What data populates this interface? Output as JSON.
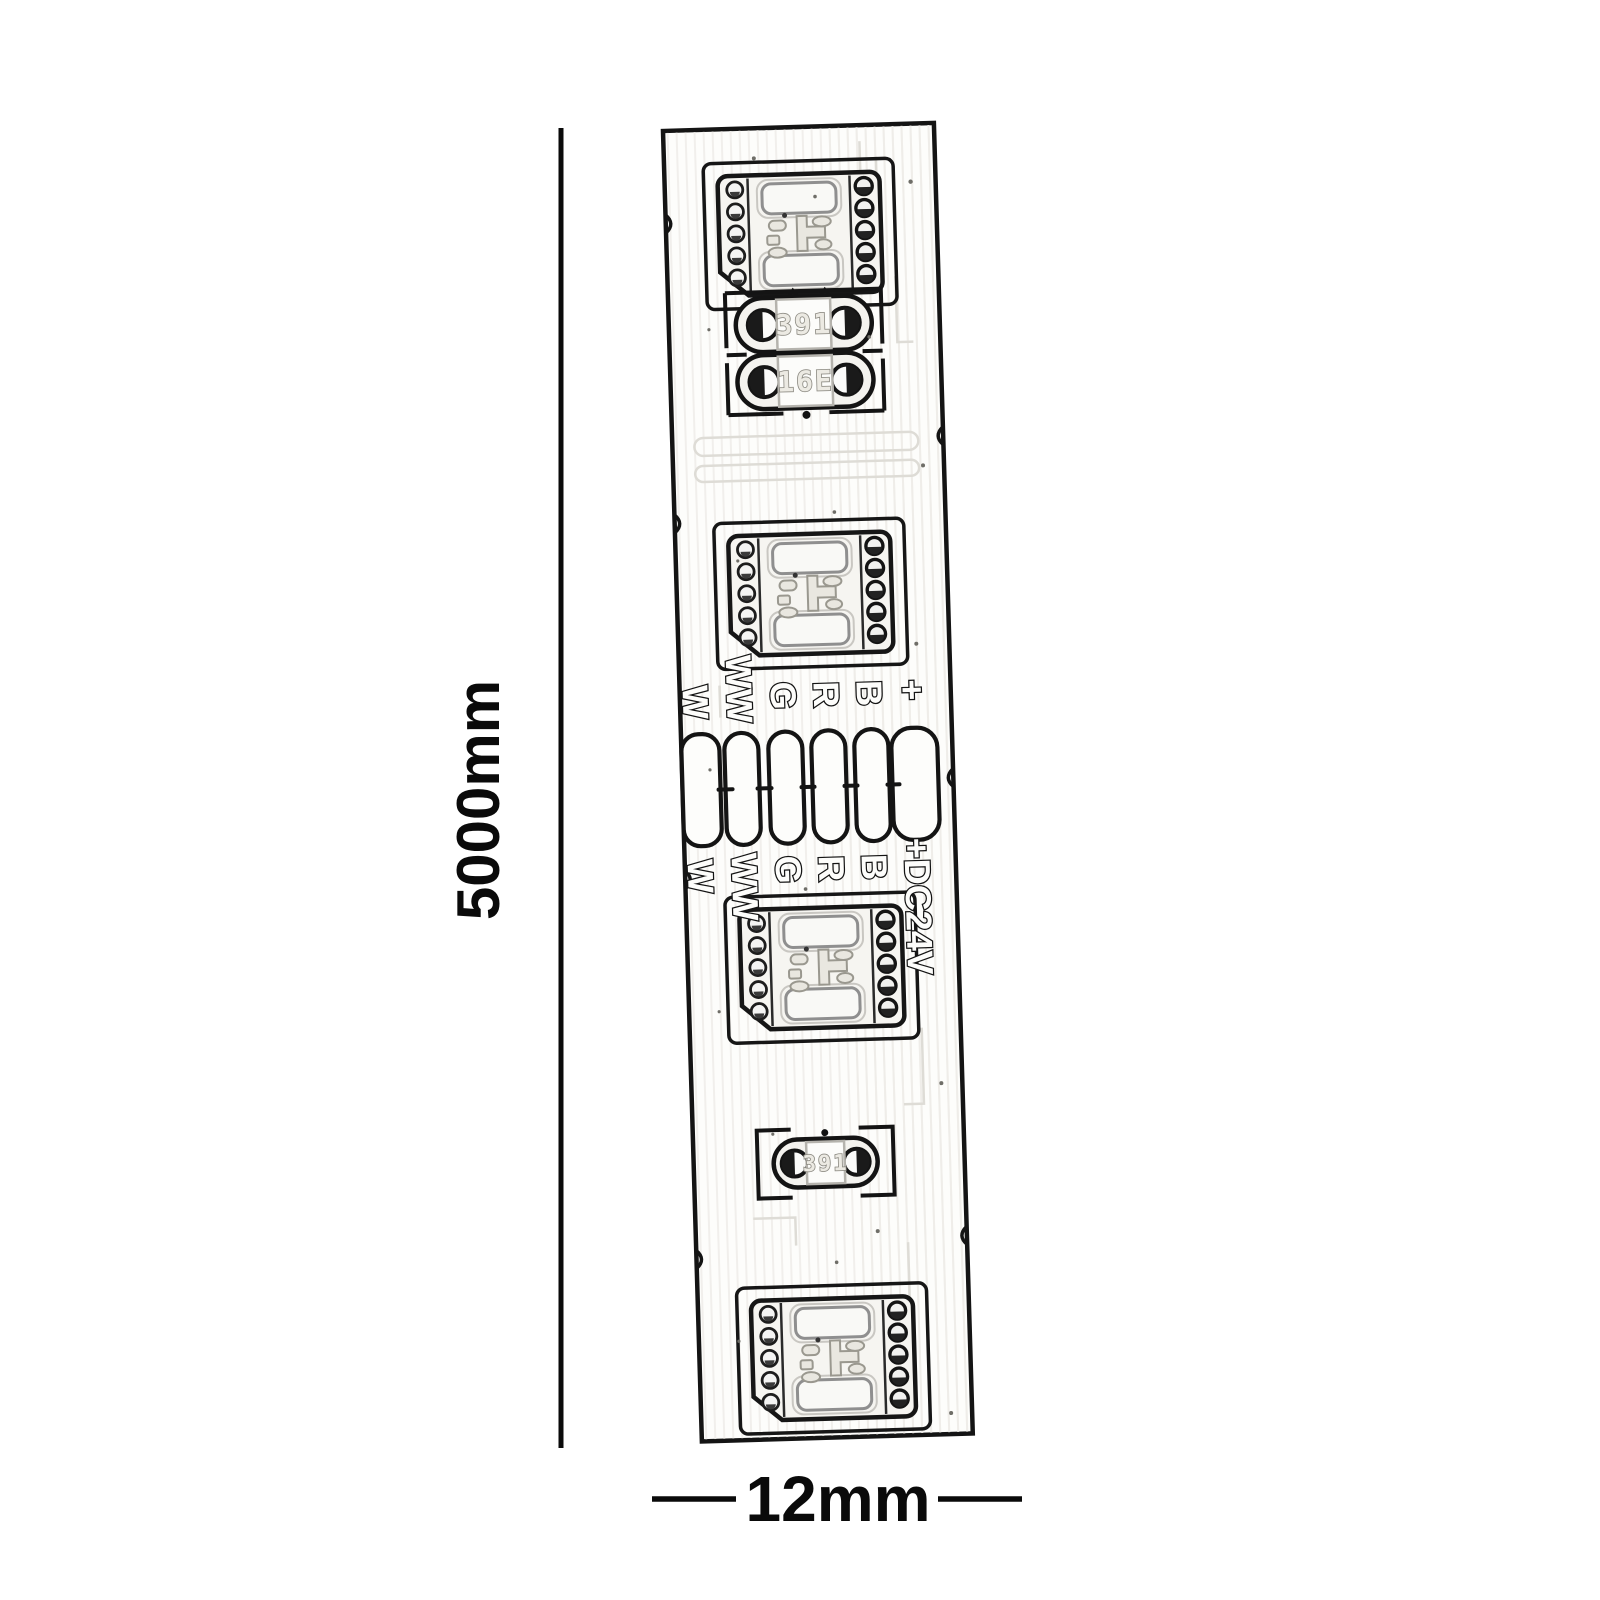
{
  "annotations": {
    "length_label": "5000mm",
    "width_label": "12mm"
  },
  "strip": {
    "pad_labels_upper": [
      "W",
      "WW",
      "G",
      "R",
      "B",
      "+"
    ],
    "pad_labels_lower": [
      "W",
      "WW",
      "G",
      "R",
      "B"
    ],
    "power_label": "+DC24V",
    "resistors": {
      "r1": "391",
      "r2": "16E",
      "r3": "391"
    },
    "led_chip_count": 4,
    "solder_pad_count": 6
  },
  "colors": {
    "line_ink": "#141414",
    "dimension_ink": "#0a0a0a",
    "marking_gray": "#8f8d85",
    "background": "#ffffff"
  }
}
